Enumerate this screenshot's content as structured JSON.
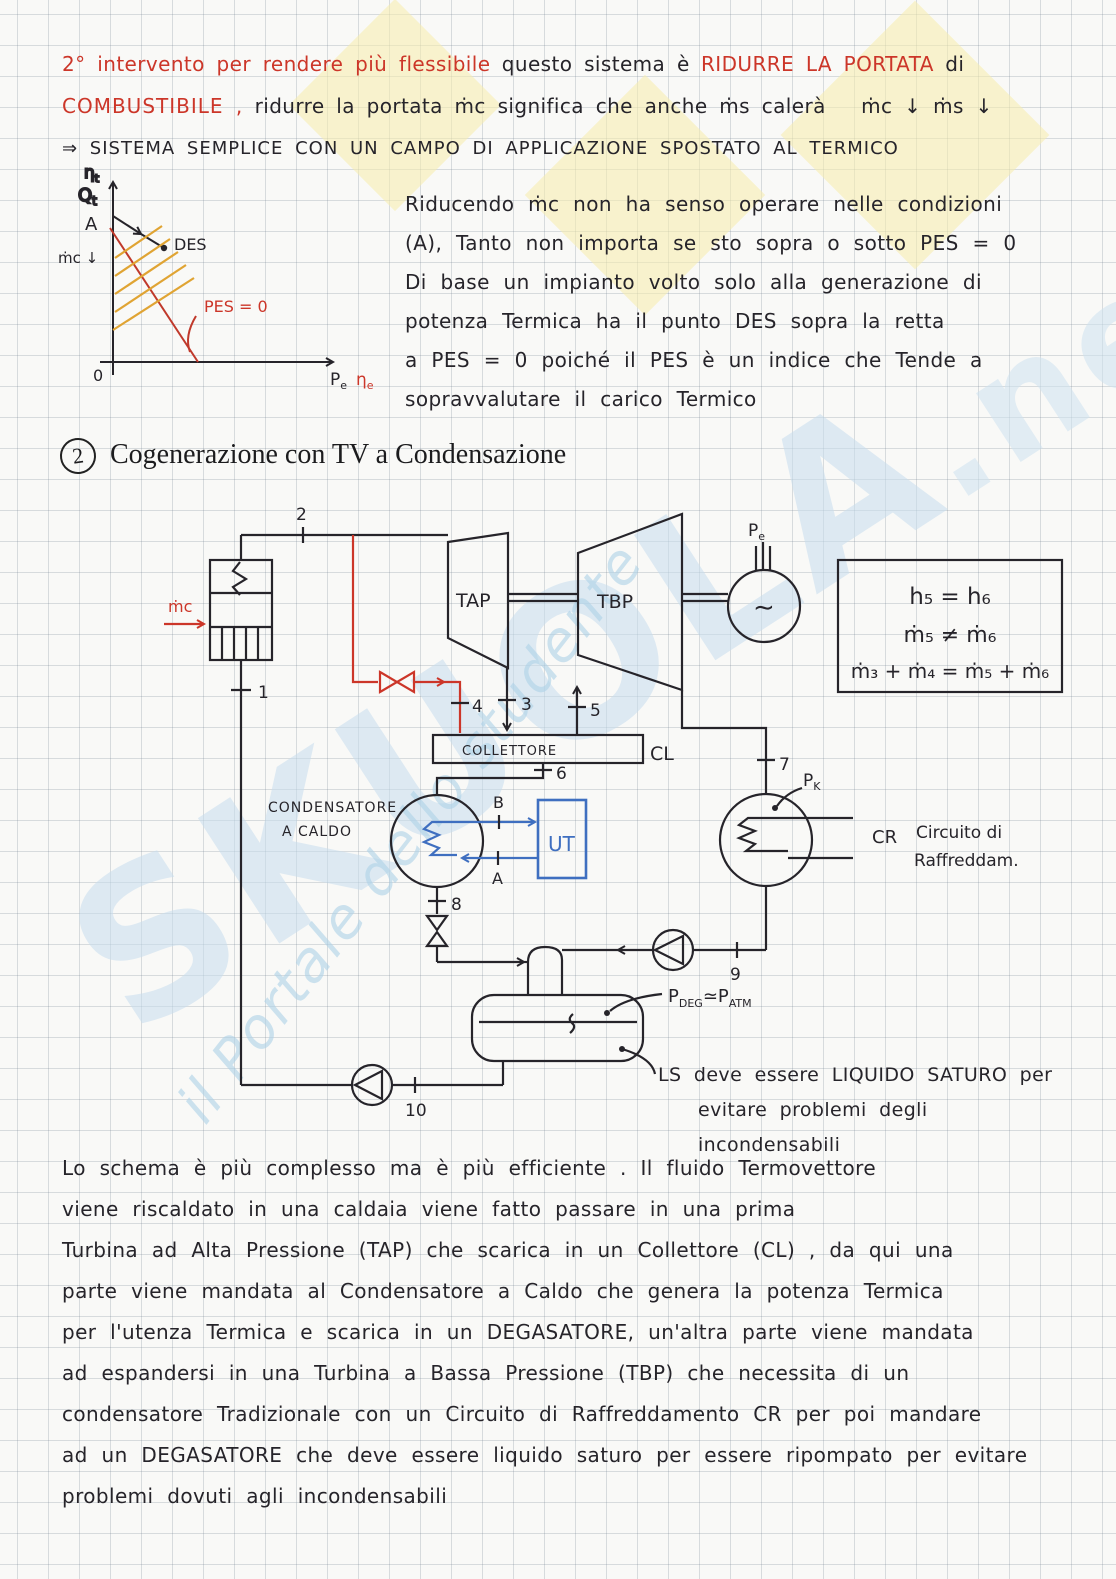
{
  "watermark": {
    "brand": "SKUOLA",
    "suffix": ".net",
    "tagline": "il Portale dello studente"
  },
  "intro": {
    "line1_red": "2° intervento per rendere più flessibile",
    "line1_black": "questo sistema è",
    "line1_red2": "RIDURRE LA PORTATA",
    "line1_black2": "di",
    "line2_red": "COMBUSTIBILE ,",
    "line2_black": "ridurre la portata ṁc significa che anche ṁs calerà",
    "line2_marks": "ṁc ↓   ṁs ↓",
    "line3": "⇒ SISTEMA SEMPLICE   CON UN CAMPO DI APPLICAZIONE   SPOSTATO AL TERMICO"
  },
  "chart": {
    "eta_t": {
      "base": "η",
      "sub": "t"
    },
    "q_t": {
      "base": "Q",
      "sub": "t"
    },
    "a": "A",
    "des": "DES",
    "mc_down": "ṁc ↓",
    "pes": "PES = 0",
    "zero": "0",
    "p_e": {
      "base": "P",
      "sub": "e"
    },
    "eta_e": {
      "base": "η",
      "sub": "e"
    }
  },
  "chart_data": {
    "type": "line",
    "title": "",
    "xlabel": "Pe (ηe)",
    "ylabel": "Qt (ηt)",
    "grid": false,
    "legend_position": "none",
    "axis_ranges": {
      "x": [
        0,
        1
      ],
      "y": [
        0,
        1
      ]
    },
    "series": [
      {
        "name": "PES = 0 boundary",
        "color": "#cc3629",
        "x": [
          0.0,
          0.38
        ],
        "y": [
          0.88,
          0.0
        ]
      },
      {
        "name": "operating segment A to DES",
        "color": "#26242a",
        "x": [
          0.0,
          0.23
        ],
        "y": [
          0.95,
          0.74
        ]
      }
    ],
    "annotations": [
      "A",
      "DES",
      "PES = 0",
      "ṁc ↓",
      "0"
    ],
    "notes": "qualitative hand sketch; yellow hatching between axis, A-DES segment and PES=0 line; arrow along A-DES segment"
  },
  "sidenote": {
    "lines": [
      "Riducendo ṁc non ha senso operare nelle condizioni",
      "(A), Tanto non importa se   sto sopra o sotto PES = 0",
      "Di base un impianto volto solo alla generazione di",
      "potenza Termica ha il punto DES sopra la retta",
      "a PES = 0   poiché il PES è un indice che Tende a",
      "sopravvalutare il carico Termico"
    ]
  },
  "heading": {
    "number": "2",
    "title": "Cogenerazione con TV a Condensazione"
  },
  "diagram": {
    "mc": "ṁc",
    "n1": "1",
    "n2": "2",
    "n3": "3",
    "n4": "4",
    "n5": "5",
    "n6": "6",
    "n7": "7",
    "n8": "8",
    "n9": "9",
    "n10": "10",
    "tap": "TAP",
    "tbp": "TBP",
    "gen": "∼",
    "pe_p": "P",
    "pe_sub": "e",
    "collettore": "COLLETTORE",
    "cl": "CL",
    "cond1": "CONDENSATORE",
    "cond2": "A  CALDO",
    "b": "B",
    "a": "A",
    "ut": "UT",
    "pk_p": "P",
    "pk_sub": "K",
    "cr": "CR",
    "cr1": "Circuito di",
    "cr2": "Raffreddam.",
    "pdeg_p": "P",
    "pdeg_sub": "DEG",
    "approx": "≃",
    "patm_p": "P",
    "patm_sub": "ATM",
    "equations": [
      "h₅ = h₆",
      "ṁ₅ ≠ ṁ₆",
      "ṁ₃ + ṁ₄ = ṁ₅ + ṁ₆"
    ],
    "ls_lines": [
      "LS   deve essere   LIQUIDO SATURO per",
      "evitare  problemi  degli",
      "incondensabili"
    ]
  },
  "paragraph": {
    "lines": [
      "Lo schema è più complesso ma è più efficiente . Il fluido Termovettore",
      "viene riscaldato in una caldaia viene fatto passare in una prima",
      "Turbina ad Alta Pressione (TAP) che scarica in un Collettore (CL) , da qui una",
      "parte viene mandata al Condensatore a Caldo che genera la potenza Termica",
      "per l'utenza Termica e scarica in un DEGASATORE, un'altra parte viene mandata",
      "ad espandersi in una Turbina a Bassa Pressione (TBP) che necessita di un",
      "condensatore Tradizionale con un Circuito di Raffreddamento CR per poi mandare",
      "ad un DEGASATORE che deve essere liquido saturo per essere ripompato per evitare",
      "problemi dovuti agli incondensabili"
    ]
  }
}
